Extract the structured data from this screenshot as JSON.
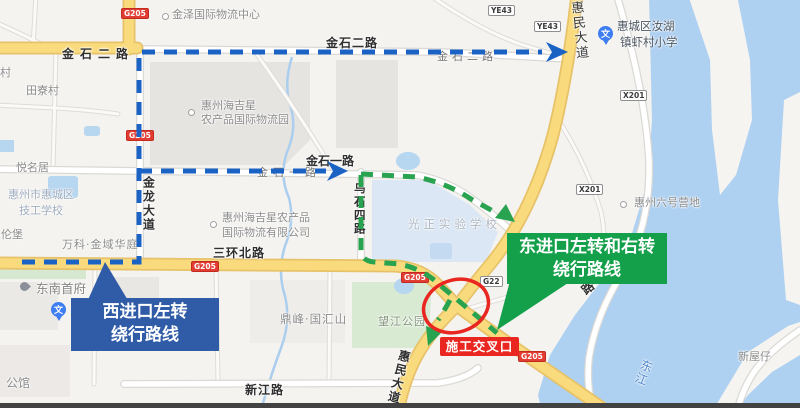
{
  "labels": {
    "jinze": "金泽国际物流中心",
    "jinshi2_bold_west": "金石二路",
    "jinshi2_bold_east": "金石二路",
    "jinshi2_gray": "金石二路",
    "jinshi1_bold": "金石一路",
    "jinshi1_gray": "金石一路",
    "jinlong": "金龙大道",
    "sanhuan": "三环北路",
    "huimin_top": "惠民大道",
    "huimin_bottom": "惠民大道",
    "wushi4": "乌石四路",
    "xinjiang": "新江路",
    "village": "村",
    "tianliao": "田寮村",
    "yueming": "悦名居",
    "lunbao": "伦堡",
    "tech1": "惠州市惠城区",
    "tech2": "技工学校",
    "wanke": "万科·金域华庭",
    "dongnan": "东南首府",
    "gongguan": "公馆",
    "haijixing_park1": "惠州海吉星",
    "haijixing_park2": "农产品国际物流园",
    "haijixing_co1": "惠州海吉星农产品",
    "haijixing_co2": "国际物流有限公司",
    "guangzheng": "光正实验学校",
    "dingfeng": "鼎峰·国汇山",
    "wangjiang": "望江公园",
    "road_char": "路",
    "camp": "惠州六号营地",
    "xiacun1": "惠城区汝湖",
    "xiacun2": "镇虾村小学",
    "xinwuzai": "新屋仔",
    "dongjiang": "东江"
  },
  "shields": {
    "g205": "G205",
    "g22": "G22",
    "x201": "X201",
    "ye43": "YE43"
  },
  "icons": {
    "school_glyph": "文"
  },
  "callouts": {
    "west_line1": "西进口左转",
    "west_line2": "绕行路线",
    "east_line1": "东进口左转和右转",
    "east_line2": "绕行路线",
    "construction": "施工交叉口"
  },
  "colors": {
    "route_west": "#1b62c5",
    "route_east": "#2aa350",
    "highlight": "#e9261f",
    "callout_west_bg": "#305ca7",
    "callout_east_bg": "#14a04a",
    "water": "#aed0f1",
    "major_road": "#f9db7e"
  }
}
